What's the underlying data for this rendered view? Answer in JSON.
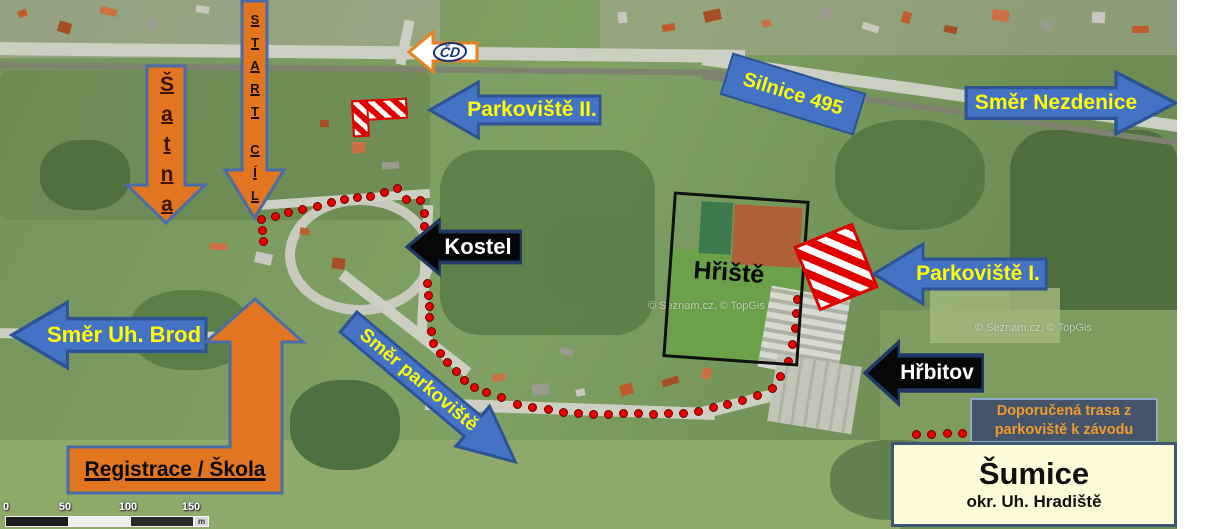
{
  "annotations": {
    "satna_letters": [
      "Š",
      "a",
      "t",
      "n",
      "a"
    ],
    "start_letters": [
      "S",
      "T",
      "A",
      "R",
      "T"
    ],
    "cil_letters": [
      "C",
      "Í",
      "L"
    ],
    "cd": "ČD",
    "parkoviste2": "Parkoviště II.",
    "silnice495": "Silnice 495",
    "smer_nezdenice": "Směr Nezdenice",
    "kostel": "Kostel",
    "hriste": "Hřiště",
    "parkoviste1": "Parkoviště I.",
    "smer_uh_brod": "Směr Uh. Brod",
    "registrace_skola": "Registrace / Škola",
    "smer_parkoviste": "Směr parkoviště",
    "hrbitov": "Hřbitov"
  },
  "legend": {
    "line1": "Doporučená trasa z",
    "line2": "parkoviště k závodu"
  },
  "title_box": {
    "town": "Šumice",
    "district": "okr. Uh. Hradiště"
  },
  "scalebar": {
    "ticks": [
      "0",
      "50",
      "100",
      "150"
    ],
    "unit": "m"
  },
  "watermarks": [
    "© Seznam.cz, © TopGis",
    "© Seznam.cz, © TopGis"
  ],
  "colors": {
    "arrow_orange": "#E2751F",
    "orange_border": "#4A6DA7",
    "arrow_blue": "#4472C4",
    "blue_border": "#2E5395",
    "label_yellow": "#FFFF00",
    "arrow_black": "#0A0A0A",
    "route_dot_red": "#E60000",
    "legend_bg": "#44546A",
    "legend_text": "#EF9B2D",
    "town_box_bg": "#FDFBD8",
    "hatch_red": "#E10000"
  },
  "route": {
    "dots": [
      [
        261,
        219
      ],
      [
        262,
        230
      ],
      [
        263,
        241
      ],
      [
        275,
        216
      ],
      [
        288,
        212
      ],
      [
        302,
        209
      ],
      [
        317,
        206
      ],
      [
        331,
        202
      ],
      [
        344,
        199
      ],
      [
        357,
        197
      ],
      [
        370,
        196
      ],
      [
        384,
        192
      ],
      [
        397,
        188
      ],
      [
        406,
        199
      ],
      [
        420,
        200
      ],
      [
        424,
        213
      ],
      [
        424,
        226
      ],
      [
        427,
        283
      ],
      [
        428,
        295
      ],
      [
        429,
        306
      ],
      [
        429,
        317
      ],
      [
        431,
        331
      ],
      [
        433,
        343
      ],
      [
        440,
        353
      ],
      [
        447,
        362
      ],
      [
        456,
        371
      ],
      [
        464,
        380
      ],
      [
        474,
        387
      ],
      [
        486,
        392
      ],
      [
        501,
        397
      ],
      [
        517,
        404
      ],
      [
        532,
        407
      ],
      [
        548,
        409
      ],
      [
        563,
        412
      ],
      [
        578,
        413
      ],
      [
        593,
        414
      ],
      [
        608,
        414
      ],
      [
        623,
        413
      ],
      [
        638,
        413
      ],
      [
        653,
        414
      ],
      [
        668,
        413
      ],
      [
        683,
        413
      ],
      [
        698,
        411
      ],
      [
        713,
        407
      ],
      [
        727,
        404
      ],
      [
        742,
        400
      ],
      [
        757,
        395
      ],
      [
        772,
        388
      ],
      [
        780,
        376
      ],
      [
        788,
        361
      ],
      [
        792,
        344
      ],
      [
        795,
        328
      ],
      [
        796,
        313
      ],
      [
        797,
        299
      ]
    ],
    "legend_dots": [
      [
        916,
        434
      ],
      [
        931,
        434
      ],
      [
        947,
        433
      ],
      [
        962,
        433
      ],
      [
        978,
        433
      ]
    ]
  }
}
